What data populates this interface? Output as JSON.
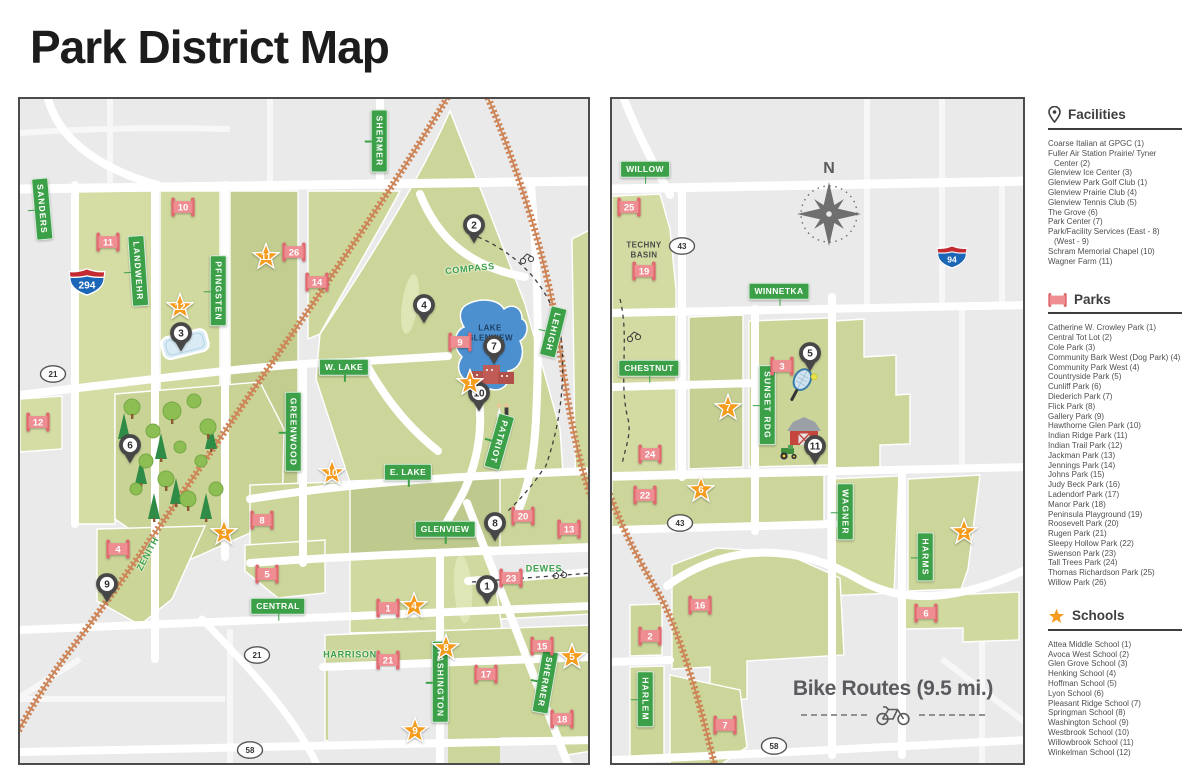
{
  "title": "Park District Map",
  "compass": {
    "label": "N"
  },
  "bike_note": {
    "text": "Bike Routes (9.5 mi.)"
  },
  "colors": {
    "map_bg": "#eaeaea",
    "parcel_green": "#ccd69b",
    "water": "#4d90cf",
    "railroad": "#cd8457",
    "street_label_bg": "#3ba047",
    "park_marker": "#ee8e92",
    "park_marker_dark": "#e16a70",
    "school_star": "#f59c1e",
    "facility_pin": "#474747",
    "interstate_blue": "#1c66b8",
    "interstate_red": "#c32b31"
  },
  "legend": {
    "facilities": {
      "heading": "Facilities",
      "items": [
        "Coarse Italian at GPGC (1)",
        "Fuller Air Station Prairie/ Tyner Center (2)",
        "Glenview Ice Center (3)",
        "Glenview Park Golf Club (1)",
        "Glenview Prairie Club (4)",
        "Glenview Tennis Club (5)",
        "The Grove (6)",
        "Park Center (7)",
        "Park/Facility Services (East - 8) (West - 9)",
        "Schram Memorial Chapel (10)",
        "Wagner Farm (11)"
      ]
    },
    "parks": {
      "heading": "Parks",
      "items": [
        "Catherine W. Crowley Park (1)",
        "Central Tot Lot (2)",
        "Cole Park (3)",
        "Community Bark West (Dog Park) (4)",
        "Community Park West (4)",
        "Countryside Park (5)",
        "Cunliff Park (6)",
        "Diederich Park (7)",
        "Flick Park (8)",
        "Gallery Park (9)",
        "Hawthorne Glen Park (10)",
        "Indian Ridge Park (11)",
        "Indian Trail Park (12)",
        "Jackman Park (13)",
        "Jennings Park (14)",
        "Johns Park (15)",
        "Judy Beck Park (16)",
        "Ladendorf Park (17)",
        "Manor Park (18)",
        "Peninsula Playground (19)",
        "Roosevelt Park (20)",
        "Rugen Park (21)",
        "Sleepy Hollow Park (22)",
        "Swenson Park (23)",
        "Tall Trees Park (24)",
        "Thomas Richardson Park (25)",
        "Willow Park (26)"
      ]
    },
    "schools": {
      "heading": "Schools",
      "items": [
        "Attea Middle School (1)",
        "Avoca West School (2)",
        "Glen Grove School (3)",
        "Henking School (4)",
        "Hoffman School (5)",
        "Lyon School (6)",
        "Pleasant Ridge School (7)",
        "Springman School (8)",
        "Washington School (9)",
        "Westbrook School (10)",
        "Willowbrook School (11)",
        "Winkelman School (12)"
      ]
    }
  },
  "maps": {
    "west": {
      "street_labels": [
        {
          "text": "SANDERS",
          "x": 22,
          "y": 110,
          "v": 1,
          "rot": -5
        },
        {
          "text": "LANDWEHR",
          "x": 118,
          "y": 172,
          "v": 1,
          "rot": -4
        },
        {
          "text": "PFINGSTEN",
          "x": 198,
          "y": 192,
          "v": 1,
          "rot": 0
        },
        {
          "text": "SHERMER",
          "x": 359,
          "y": 42,
          "v": 1,
          "rot": 0
        },
        {
          "text": "W. LAKE",
          "x": 324,
          "y": 268,
          "v": 0,
          "rot": 0
        },
        {
          "text": "LEHIGH",
          "x": 533,
          "y": 233,
          "v": 1,
          "rot": 14
        },
        {
          "text": "GREENWOOD",
          "x": 273,
          "y": 333,
          "v": 1,
          "rot": 0
        },
        {
          "text": "E. LAKE",
          "x": 388,
          "y": 373,
          "v": 0,
          "rot": 0
        },
        {
          "text": "PATRIOT",
          "x": 479,
          "y": 343,
          "v": 1,
          "rot": 16
        },
        {
          "text": "GLENVIEW",
          "x": 425,
          "y": 430,
          "v": 0,
          "rot": 0
        },
        {
          "text": "CENTRAL",
          "x": 258,
          "y": 507,
          "v": 0,
          "rot": 0
        },
        {
          "text": "WASHINGTON",
          "x": 420,
          "y": 583,
          "v": 1,
          "rot": 0
        },
        {
          "text": "SHERMER",
          "x": 525,
          "y": 583,
          "v": 1,
          "rot": 10
        },
        {
          "text": "COMPASS",
          "x": 450,
          "y": 170,
          "plain": 1,
          "rot": -6
        },
        {
          "text": "DEWES",
          "x": 524,
          "y": 470,
          "plain": 1,
          "rot": 0
        },
        {
          "text": "HARRISON",
          "x": 330,
          "y": 556,
          "plain": 1,
          "rot": 0
        },
        {
          "text": "ZENITH",
          "x": 128,
          "y": 455,
          "plain": 1,
          "rot": -62
        }
      ],
      "area_labels": [
        {
          "text": "LAKE\nGLENVIEW",
          "x": 470,
          "y": 234,
          "color": "#1e3f63"
        }
      ],
      "markers": [
        {
          "t": "facility",
          "n": "2",
          "x": 454,
          "y": 130
        },
        {
          "t": "facility",
          "n": "4",
          "x": 404,
          "y": 210
        },
        {
          "t": "facility",
          "n": "7",
          "x": 474,
          "y": 251
        },
        {
          "t": "facility",
          "n": "10",
          "x": 459,
          "y": 298
        },
        {
          "t": "facility",
          "n": "3",
          "x": 161,
          "y": 238
        },
        {
          "t": "facility",
          "n": "6",
          "x": 110,
          "y": 350
        },
        {
          "t": "facility",
          "n": "9",
          "x": 87,
          "y": 489
        },
        {
          "t": "facility",
          "n": "8",
          "x": 475,
          "y": 428
        },
        {
          "t": "facility",
          "n": "1",
          "x": 467,
          "y": 491
        },
        {
          "t": "park",
          "n": "10",
          "x": 163,
          "y": 108
        },
        {
          "t": "park",
          "n": "11",
          "x": 88,
          "y": 143
        },
        {
          "t": "park",
          "n": "26",
          "x": 274,
          "y": 153
        },
        {
          "t": "park",
          "n": "14",
          "x": 297,
          "y": 183
        },
        {
          "t": "park",
          "n": "9",
          "x": 440,
          "y": 243
        },
        {
          "t": "park",
          "n": "12",
          "x": 18,
          "y": 323
        },
        {
          "t": "park",
          "n": "8",
          "x": 242,
          "y": 421
        },
        {
          "t": "park",
          "n": "4",
          "x": 98,
          "y": 450
        },
        {
          "t": "park",
          "n": "5",
          "x": 247,
          "y": 475
        },
        {
          "t": "park",
          "n": "20",
          "x": 503,
          "y": 417
        },
        {
          "t": "park",
          "n": "13",
          "x": 549,
          "y": 430
        },
        {
          "t": "park",
          "n": "23",
          "x": 491,
          "y": 479
        },
        {
          "t": "park",
          "n": "1",
          "x": 368,
          "y": 509
        },
        {
          "t": "park",
          "n": "21",
          "x": 368,
          "y": 561
        },
        {
          "t": "park",
          "n": "17",
          "x": 466,
          "y": 575
        },
        {
          "t": "park",
          "n": "15",
          "x": 522,
          "y": 547
        },
        {
          "t": "park",
          "n": "18",
          "x": 542,
          "y": 620
        },
        {
          "t": "school",
          "n": "11",
          "x": 246,
          "y": 157
        },
        {
          "t": "school",
          "n": "12",
          "x": 160,
          "y": 207
        },
        {
          "t": "school",
          "n": "1",
          "x": 450,
          "y": 283
        },
        {
          "t": "school",
          "n": "10",
          "x": 312,
          "y": 373
        },
        {
          "t": "school",
          "n": "3",
          "x": 204,
          "y": 433
        },
        {
          "t": "school",
          "n": "4",
          "x": 394,
          "y": 506
        },
        {
          "t": "school",
          "n": "8",
          "x": 426,
          "y": 548
        },
        {
          "t": "school",
          "n": "5",
          "x": 552,
          "y": 557
        },
        {
          "t": "school",
          "n": "9",
          "x": 395,
          "y": 631
        }
      ],
      "shields": [
        {
          "kind": "interstate",
          "n": "294",
          "x": 67,
          "y": 183
        },
        {
          "kind": "oval",
          "n": "21",
          "x": 33,
          "y": 275
        },
        {
          "kind": "oval",
          "n": "21",
          "x": 237,
          "y": 556
        },
        {
          "kind": "oval",
          "n": "58",
          "x": 230,
          "y": 651
        }
      ]
    },
    "east": {
      "street_labels": [
        {
          "text": "WILLOW",
          "x": 33,
          "y": 70,
          "v": 0,
          "rot": 0
        },
        {
          "text": "WINNETKA",
          "x": 167,
          "y": 192,
          "v": 0,
          "rot": 0
        },
        {
          "text": "CHESTNUT",
          "x": 37,
          "y": 269,
          "v": 0,
          "rot": 0
        },
        {
          "text": "SUNSET RDG",
          "x": 155,
          "y": 306,
          "v": 1,
          "rot": 0
        },
        {
          "text": "WAGNER",
          "x": 233,
          "y": 413,
          "v": 1,
          "rot": 0
        },
        {
          "text": "HARMS",
          "x": 313,
          "y": 458,
          "v": 1,
          "rot": 0
        },
        {
          "text": "HARLEM",
          "x": 33,
          "y": 600,
          "v": 1,
          "rot": 0
        }
      ],
      "area_labels": [
        {
          "text": "TECHNY\nBASIN",
          "x": 32,
          "y": 151,
          "color": "#4a4a4a"
        }
      ],
      "markers": [
        {
          "t": "facility",
          "n": "5",
          "x": 198,
          "y": 258
        },
        {
          "t": "facility",
          "n": "11",
          "x": 203,
          "y": 351
        },
        {
          "t": "park",
          "n": "25",
          "x": 17,
          "y": 108
        },
        {
          "t": "park",
          "n": "19",
          "x": 32,
          "y": 172
        },
        {
          "t": "park",
          "n": "3",
          "x": 170,
          "y": 267
        },
        {
          "t": "park",
          "n": "24",
          "x": 38,
          "y": 355
        },
        {
          "t": "park",
          "n": "22",
          "x": 33,
          "y": 396
        },
        {
          "t": "park",
          "n": "16",
          "x": 88,
          "y": 506
        },
        {
          "t": "park",
          "n": "2",
          "x": 38,
          "y": 537
        },
        {
          "t": "park",
          "n": "7",
          "x": 113,
          "y": 626
        },
        {
          "t": "park",
          "n": "6",
          "x": 314,
          "y": 514
        },
        {
          "t": "school",
          "n": "7",
          "x": 116,
          "y": 308
        },
        {
          "t": "school",
          "n": "6",
          "x": 89,
          "y": 390
        },
        {
          "t": "school",
          "n": "2",
          "x": 352,
          "y": 432
        }
      ],
      "shields": [
        {
          "kind": "oval",
          "n": "43",
          "x": 70,
          "y": 147
        },
        {
          "kind": "oval",
          "n": "43",
          "x": 68,
          "y": 424
        },
        {
          "kind": "oval",
          "n": "58",
          "x": 162,
          "y": 647
        },
        {
          "kind": "interstate",
          "n": "94",
          "x": 340,
          "y": 158
        }
      ]
    }
  }
}
